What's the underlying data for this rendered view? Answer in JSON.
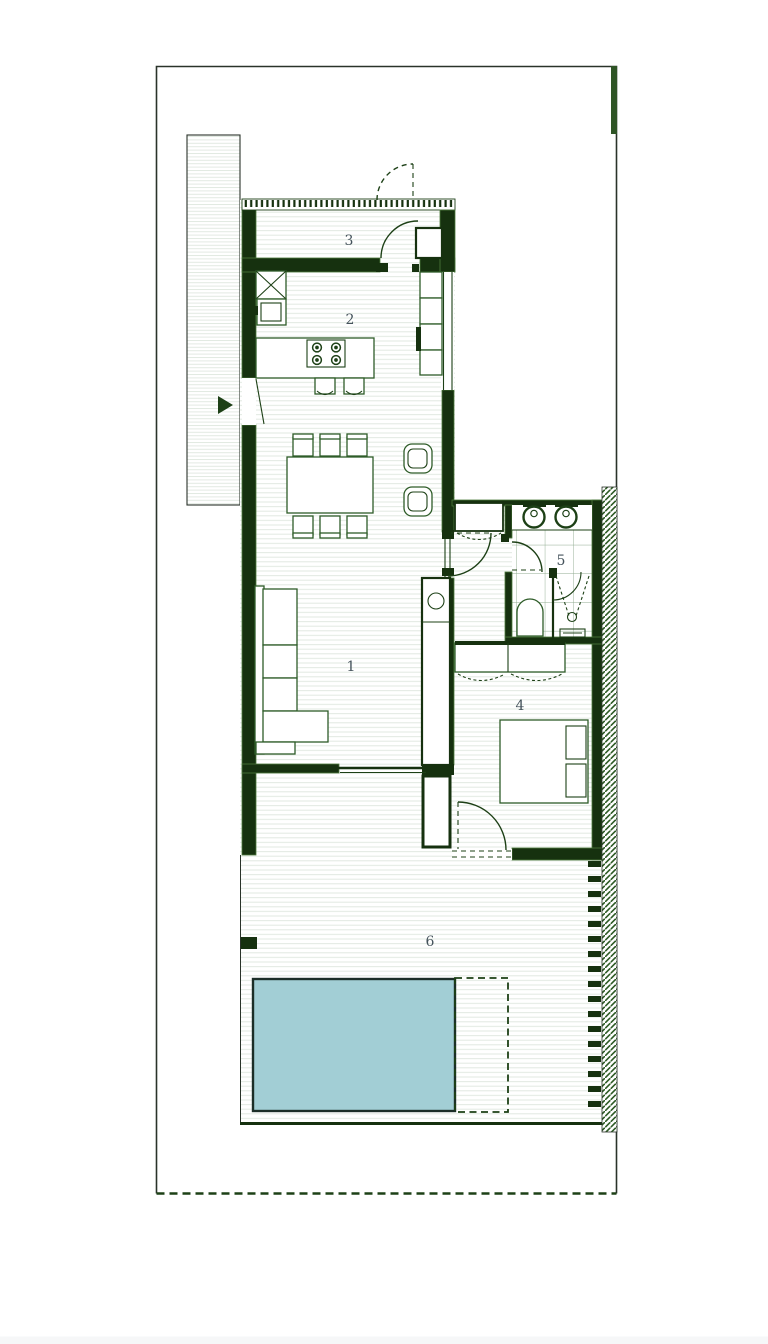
{
  "plan": {
    "rooms": [
      {
        "id": "living-room",
        "label": "1"
      },
      {
        "id": "kitchen",
        "label": "2"
      },
      {
        "id": "entry-hall",
        "label": "3"
      },
      {
        "id": "bedroom",
        "label": "4"
      },
      {
        "id": "bathroom",
        "label": "5"
      },
      {
        "id": "terrace",
        "label": "6"
      }
    ]
  },
  "colors": {
    "wall": "#16310f",
    "wall-edge": "#4d7a3c",
    "line": "#1d4016",
    "furniture": "#2e5c28",
    "floor-line": "#e2e9e2",
    "tile-line": "#8fab8f",
    "hatch": "#2d5a24",
    "label": "#44525b",
    "pool-fill": "#a2ced5",
    "pool-border": "#1c2e28",
    "boundary": "#2a332a",
    "page-strip": "#f6f7f8"
  }
}
